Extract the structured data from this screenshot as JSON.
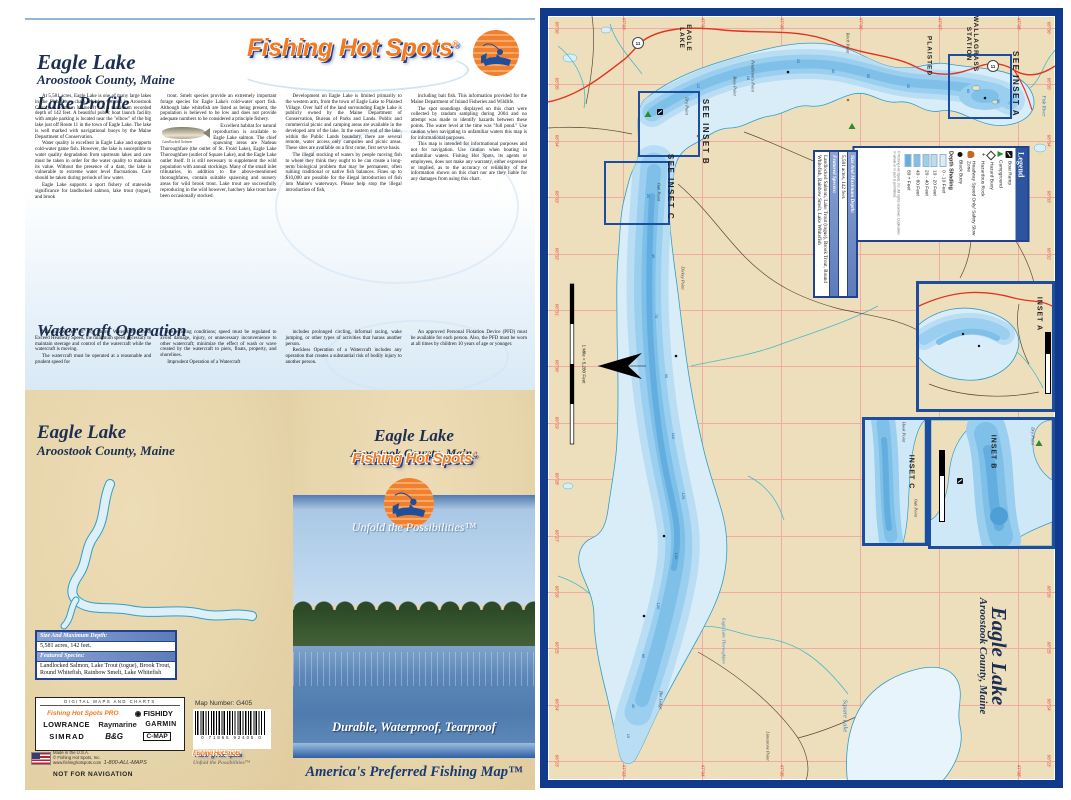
{
  "lake_name": "Eagle Lake",
  "county": "Aroostook County, Maine",
  "brand": {
    "name": "Fishing Hot Spots",
    "reg": "®",
    "tagline": "Unfold the Possibilities™",
    "pro": "Fishing Hot Spots PRO"
  },
  "colors": {
    "accent_orange": "#f4791f",
    "navy": "#1c2f52",
    "map_border_navy": "#103a8c",
    "land_tan": "#e9d8b0",
    "lake_blue": "#a5d5f0",
    "road_red": "#e03322",
    "grid_pink": "#f0aba3",
    "table_header_blue": "#5c7cba"
  },
  "lake_facts": {
    "size_header": "Size And Maximum Depth:",
    "size_value": "5,581 acres, 142 feet.",
    "species_header": "Featured Species:",
    "species_value": "Landlocked Salmon, Lake Trout (togue), Brook Trout, Round Whitefish, Rainbow Smelt, Lake Whitefish"
  },
  "page_left": {
    "lake_profile_heading": "Lake Profile",
    "watercraft_heading": "Watercraft Operation",
    "salmon_caption": "Landlocked Salmon",
    "lp_col1": [
      "At 5,581 acres, Eagle Lake is one of many large lakes in the Fish River chain of lakes located in Aroostook County in northern Maine. It has a maximum recorded depth of 142 feet. A beautiful public boat launch facility with ample parking is located near the \"elbow\" of the big lake just off Route 11 in the town of Eagle Lake. The lake is well marked with navigational buoys by the Maine Department of Conservation.",
      "Water quality is excellent in Eagle Lake and supports cold-water game fish. However, the lake is susceptible to water quality degradation from upstream lakes and care must be taken in order for the water quality to maintain its value. Without the presence of a dam, the lake is vulnerable to extreme water level fluctuations. Care should be taken during periods of low water.",
      "Eagle Lake supports a sport fishery of statewide significance for landlocked salmon, lake trout (togue), and brook"
    ],
    "lp_col2_before_fig": [
      "trout. Smelt species provide an extremely important forage species for Eagle Lake's cold-water sport fish. Although lake whitefish are listed as being present, the population is believed to be low and does not provide adequate numbers to be considered a principle fishery."
    ],
    "lp_col2_after_fig": [
      "Excellent habitat for natural reproduction is available to Eagle Lake salmon. The chief spawning areas are Nadeau Thoroughfare (the outlet of St. Froid Lake), Eagle Lake Thoroughfare (outlet of Square Lake), and the Eagle Lake outlet itself. It is still necessary to supplement the wild population with annual stockings. Many of the small inlet tributaries, in addition to the above-mentioned thoroughfares, contain suitable spawning and nursery areas for wild brook trout. Lake trout are successfully reproducing in the wild however, hatchery lake trout have been occasionally stocked."
    ],
    "lp_col3": [
      "Development on Eagle Lake is limited primarily to the western arm, from the town of Eagle Lake to Plaisted Village. Over half of the land surrounding Eagle Lake is publicly owned by the Maine Department of Conservation, Bureau of Parks and Lands. Public and commercial picnic and camping areas are available in the developed arm of the lake. In the eastern end of the lake, within the Public Lands boundary, there are several remote, water access only campsites and picnic areas. These sites are available on a first come, first serve basis.",
      "The illegal stocking of waters by people moving fish to where they think they ought to be can create a long-term biological problem that may be permanent, often ruining traditional or native fish balances. Fines up to $10,000 are possible for the illegal introduction of fish into Maine's waterways. Please help stop the illegal introduction of fish,"
    ],
    "lp_col4": [
      "including bait fish. This information provided for the Maine Department of Inland Fisheries and Wildlife.",
      "The spot soundings displayed on this chart were collected by random sampling during 2004 and no attempt was made to identify hazards between these points. The water level at the time was \"full pond.\" Use caution when navigating in unfamiliar waters this map is for informational purposes.",
      "This map is intended for informational purposes and not for navigation. Use caution when boating in unfamiliar waters. Fishing Hot Spots, its agents or employees, does not make any warranty, either expressed or implied, as to the accuracy or reliability of the information shown on this chart nor are they liable for any damages from using this chart."
    ],
    "wo_col1": [
      "Within 200 feet of any Shore, Watercraft Cannot Exceed Headway Speed, the minimum speed necessary to maintain steerage and control of the watercraft while the watercraft is moving.",
      "The watercraft must be operated at a reasonable and prudent speed for"
    ],
    "wo_col2": [
      "the existing conditions; speed must be regulated to avoid damage, injury, or unnecessary inconvenience to other watercraft; minimize the effect of wash or wave created by the watercraft to piers, floats, property, and shorelines.",
      "Imprudent Operation of a Watercraft"
    ],
    "wo_col3": [
      "includes prolonged circling, informal racing, wake jumping, or other types of activities that harass another person.",
      "Reckless Operation of a Watercraft includes any operation that creates a substantial risk of bodily injury to another person."
    ],
    "wo_col4": [
      "An approved Personal Flotation Device (PFD) must be available for each person. Also, the PFD must be worn at all times by children 10 years of age or younger."
    ]
  },
  "back_cover": {
    "partners_header": "DIGITAL MAPS AND CHARTS",
    "brands": [
      "Fishing Hot Spots PRO",
      "FISHIDY",
      "LOWRANCE",
      "Raymarine",
      "GARMIN",
      "SIMRAD",
      "B&G",
      "C-MAP"
    ],
    "map_number_label": "Map Number: G405",
    "barcode_digits": "0 71865 92405 0",
    "made_in": "Made in the U.S.A.",
    "copyright": "© Fishing Hot Spots, Inc.",
    "website": "www.fishinghotspots.com",
    "phone": "1-800-ALL-MAPS",
    "not_for_navigation": "NOT FOR NAVIGATION"
  },
  "front_cover": {
    "durability": "Durable, Waterproof, Tearproof",
    "footer": "America's Preferred Fishing Map™"
  },
  "map": {
    "labels": {
      "town_eagle_lake": "EAGLE\nLAKE",
      "town_plaisted": "PLAISTED",
      "town_wallagrass": "WALLAGRASS\nSTATION",
      "see_inset_a": "SEE INSET A",
      "see_inset_b": "SEE INSET B",
      "see_inset_c": "SEE INSET C",
      "inset_a": "INSET A",
      "inset_b": "INSET B",
      "inset_c": "INSET C",
      "fish_river": "Fish River",
      "thoroughfare": "Eagle Lake Thoroughfare",
      "square_lake": "Square Lake",
      "pt_boys": "Boys Point",
      "pt_pendleton": "Pendleton's Point",
      "pt_birch": "Birch Point",
      "pt_dry": "Dry Point",
      "pt_oak": "Oak Point",
      "pt_hook": "Hook Point",
      "pt_dickey": "Dickey Point",
      "pt_ledge": "The Ledge",
      "pt_limestone": "Limestone Point",
      "route_number": "11",
      "scale_text": "1 Mile = 5,280 Feet"
    },
    "title_vertical": "Eagle Lake",
    "subtitle_vertical": "Aroostook County, Maine",
    "legend": {
      "title": "Legend",
      "items": [
        "Boat Ramp",
        "Campground",
        "Hazard Buoy",
        "Hazardous Rock",
        "Headway Speed Only/ Safety Slow Zone",
        "Black Buoy"
      ],
      "depth_label": "Depth Shading",
      "depths": [
        "0 - 10 Feet",
        "10 - 20 Feet",
        "20 - 40 Feet",
        "40 - 80 Feet",
        "80 + Feet"
      ],
      "copyright": "© Fishing Hot Spots, Inc. All rights reserved. Duplication in whole or in part is prohibited."
    },
    "grid": {
      "lon_labels": [
        "68°36'",
        "68°35'",
        "68°34'",
        "68°33'",
        "68°32'",
        "68°31'",
        "68°30'",
        "68°29'",
        "68°28'",
        "68°27'",
        "68°26'",
        "68°25'",
        "68°24'",
        "68°23'"
      ],
      "lat_labels": [
        "47°03'",
        "47°04'",
        "47°05'",
        "47°06'",
        "47°07'",
        "47°08'"
      ]
    },
    "soundings": [
      [
        150,
        70,
        "12"
      ],
      [
        200,
        62,
        "18"
      ],
      [
        250,
        45,
        "25"
      ],
      [
        285,
        55,
        "40"
      ],
      [
        320,
        60,
        "55"
      ],
      [
        360,
        70,
        "35"
      ],
      [
        420,
        75,
        "60"
      ],
      [
        450,
        85,
        "30"
      ],
      [
        100,
        180,
        "20"
      ],
      [
        105,
        240,
        "45"
      ],
      [
        108,
        300,
        "70"
      ],
      [
        118,
        360,
        "95"
      ],
      [
        125,
        420,
        "110"
      ],
      [
        135,
        480,
        "125"
      ],
      [
        128,
        540,
        "142"
      ],
      [
        110,
        590,
        "120"
      ],
      [
        95,
        640,
        "85"
      ],
      [
        85,
        690,
        "40"
      ],
      [
        80,
        720,
        "15"
      ]
    ]
  }
}
